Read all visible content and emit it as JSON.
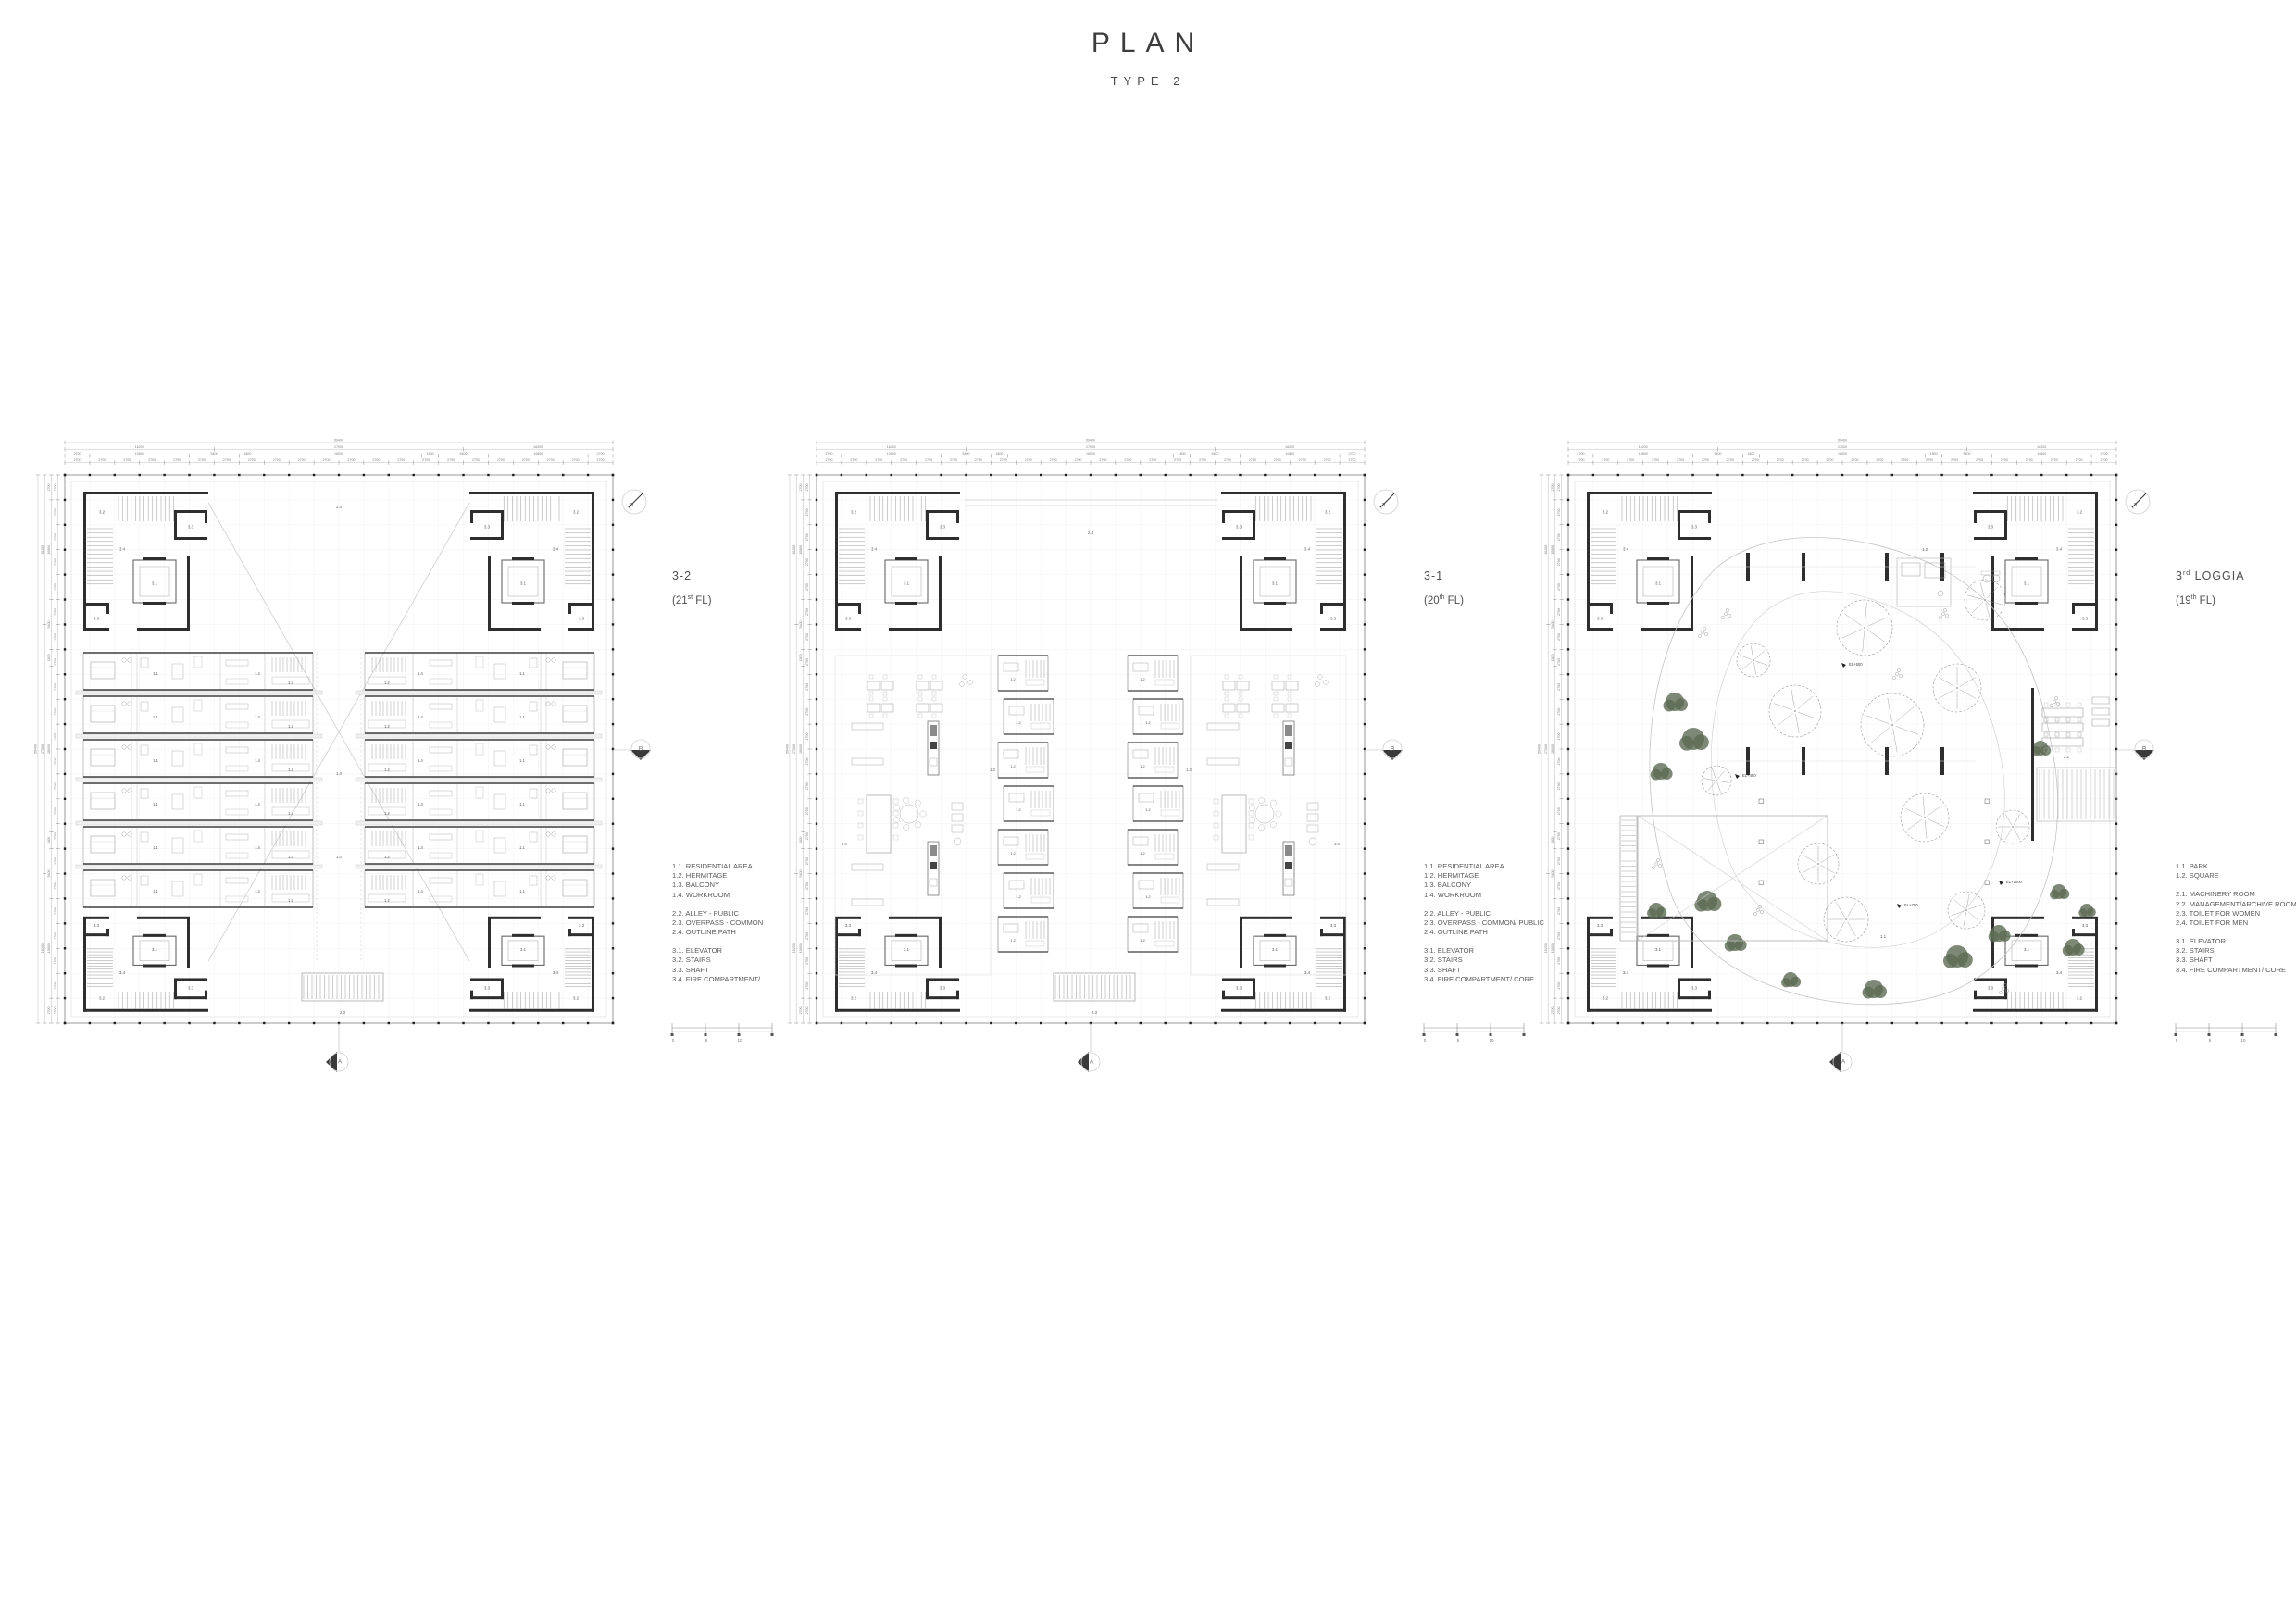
{
  "page": {
    "title": "PLAN",
    "subtitle": "TYPE 2"
  },
  "colors": {
    "wall": "#2e2e2e",
    "line_medium": "#8f8f8f",
    "line_light": "#c9c9c9",
    "text": "#555555",
    "tree_gray": "#8b908b",
    "tree_green": "#5c6b54",
    "marker_dark": "#3a3a3a"
  },
  "dims": {
    "rows": [
      {
        "values": [
          "59400"
        ]
      },
      {
        "values": [
          "16200",
          "27000",
          "16200"
        ]
      },
      {
        "values": [
          "2700",
          "10800",
          "5400",
          "1800",
          "18000",
          "1800",
          "5400",
          "10800",
          "2700"
        ]
      },
      {
        "repeat": "2700",
        "count": 22
      }
    ]
  },
  "labels": {
    "elevator": "3.1",
    "stairs": "3.2",
    "shaft": "3.3",
    "fire": "3.4",
    "residential": "1.1",
    "hermitage": "1.2",
    "balcony": "1.3",
    "workroom": "1.4",
    "alley": "2.2",
    "overpass": "2.3",
    "outline": "2.4",
    "park": "1.1",
    "square": "1.2",
    "machinery": "2.1"
  },
  "markers": {
    "section_right": "B",
    "section_bottom": "A"
  },
  "scalebar": {
    "ticks": [
      "0",
      "5",
      "10"
    ]
  },
  "plans": [
    {
      "id": "plan-3-2",
      "type": "residential",
      "name_prefix": "3-2",
      "name_sup": "",
      "name_rest": "",
      "floor_prefix": "(21",
      "floor_sup": "st",
      "floor_suffix": " FL)",
      "legend": [
        [
          "1.1. RESIDENTIAL AREA",
          "1.2. HERMITAGE",
          "1.3. BALCONY",
          "1.4. WORKROOM"
        ],
        [
          "2.2. ALLEY - PUBLIC",
          "2.3. OVERPASS - COMMON",
          "2.4. OUTLINE PATH"
        ],
        [
          "3.1. ELEVATOR",
          "3.2. STAIRS",
          "3.3. SHAFT",
          "3.4. FIRE COMPARTMENT/"
        ]
      ]
    },
    {
      "id": "plan-3-1",
      "type": "common",
      "name_prefix": "3-1",
      "name_sup": "",
      "name_rest": "",
      "floor_prefix": "(20",
      "floor_sup": "th",
      "floor_suffix": " FL)",
      "legend": [
        [
          "1.1. RESIDENTIAL AREA",
          "1.2. HERMITAGE",
          "1.3. BALCONY",
          "1.4. WORKROOM"
        ],
        [
          "2.2. ALLEY - PUBLIC",
          "2.3. OVERPASS - COMMON/ PUBLIC",
          "2.4. OUTLINE PATH"
        ],
        [
          "3.1. ELEVATOR",
          "3.2. STAIRS",
          "3.3. SHAFT",
          "3.4. FIRE COMPARTMENT/ CORE"
        ]
      ]
    },
    {
      "id": "plan-loggia",
      "type": "loggia",
      "name_prefix": "3",
      "name_sup": "rd",
      "name_rest": " LOGGIA",
      "floor_prefix": "(19",
      "floor_sup": "th",
      "floor_suffix": " FL)",
      "el_labels": [
        "EL+500",
        "EL+450",
        "EL+750",
        "EL+1000"
      ],
      "legend": [
        [
          "1.1. PARK",
          "1.2. SQUARE"
        ],
        [
          "2.1. MACHINERY  ROOM",
          "2.2. MANAGEMENT/ARCHIVE ROOM",
          "2.3. TOILET FOR WOMEN",
          "2.4. TOILET FOR MEN"
        ],
        [
          "3.1. ELEVATOR",
          "3.2. STAIRS",
          "3.3. SHAFT",
          "3.4. FIRE COMPARTMENT/ CORE"
        ]
      ]
    }
  ]
}
